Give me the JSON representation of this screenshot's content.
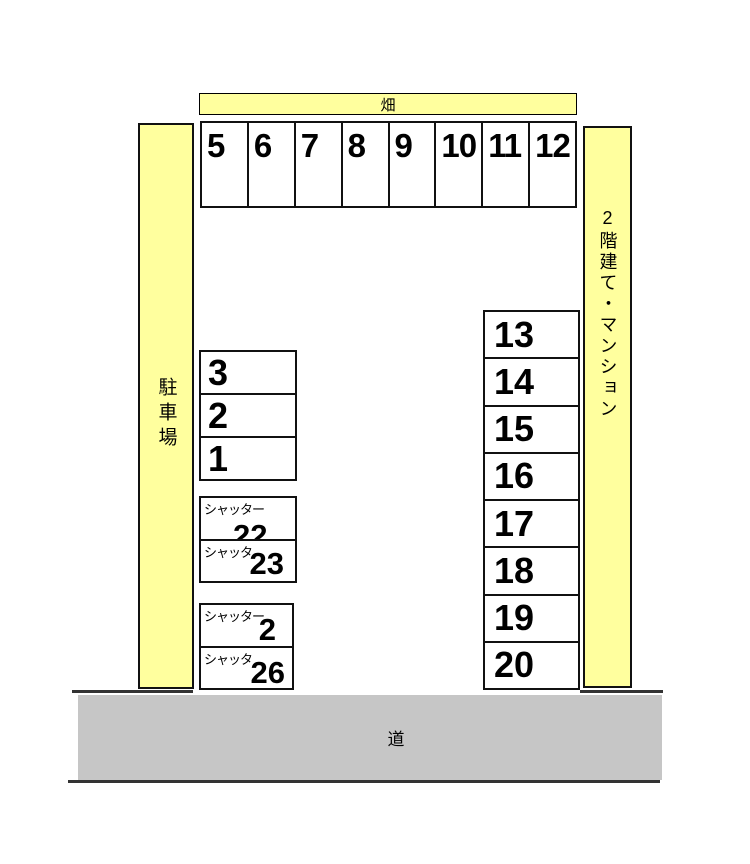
{
  "diagram": {
    "field_label": "畑",
    "parking_lot_label": "駐車場",
    "building_label": "2階建て・マンション",
    "road_label": "道"
  },
  "colors": {
    "area_yellow": "#ffff9e",
    "road_gray": "#c6c6c6",
    "line_dark": "#333333",
    "border_black": "#111111"
  },
  "top_row_spaces": [
    "5",
    "6",
    "7",
    "8",
    "9",
    "10",
    "11",
    "12"
  ],
  "left_column_spaces": [
    "3",
    "2",
    "1"
  ],
  "shutter_spaces_upper": [
    {
      "label": "シャッター",
      "number": "22"
    },
    {
      "label": "シャッタ",
      "number": "23"
    }
  ],
  "shutter_spaces_lower": [
    {
      "label": "シャッター",
      "number": "2"
    },
    {
      "label": "シャッタ",
      "number": "26"
    }
  ],
  "right_column_spaces": [
    "13",
    "14",
    "15",
    "16",
    "17",
    "18",
    "19",
    "20"
  ]
}
